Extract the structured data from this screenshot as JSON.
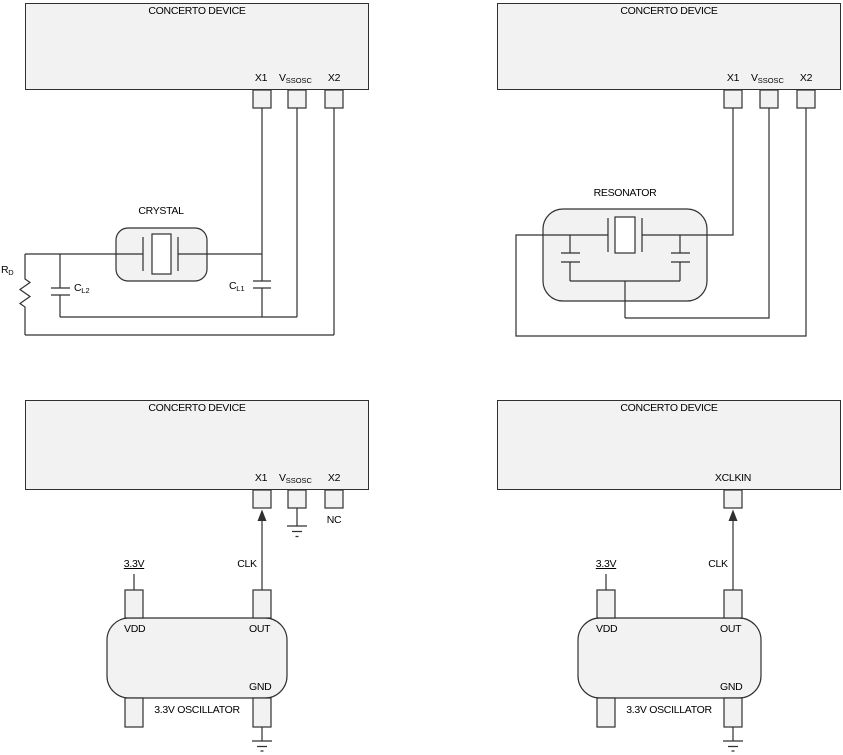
{
  "colors": {
    "stroke": "#303030",
    "box_fill": "#f2f2f2",
    "white_fill": "#ffffff"
  },
  "crystal_circuit": {
    "device_title": "CONCERTO DEVICE",
    "pin_x1": "X1",
    "pin_vssosc_main": "V",
    "pin_vssosc_sub": "SSOSC",
    "pin_x2": "X2",
    "crystal_label": "CRYSTAL",
    "rd_main": "R",
    "rd_sub": "D",
    "cl2_main": "C",
    "cl2_sub": "L2",
    "cl1_main": "C",
    "cl1_sub": "L1"
  },
  "resonator_circuit": {
    "device_title": "CONCERTO DEVICE",
    "pin_x1": "X1",
    "pin_vssosc_main": "V",
    "pin_vssosc_sub": "SSOSC",
    "pin_x2": "X2",
    "resonator_label": "RESONATOR"
  },
  "oscillator_x1_circuit": {
    "device_title": "CONCERTO DEVICE",
    "pin_x1": "X1",
    "pin_vssosc_main": "V",
    "pin_vssosc_sub": "SSOSC",
    "pin_x2": "X2",
    "nc_label": "NC",
    "supply_label": "3.3V",
    "clk_label": "CLK",
    "osc_vdd": "VDD",
    "osc_out": "OUT",
    "osc_gnd": "GND",
    "osc_title": "3.3V OSCILLATOR"
  },
  "oscillator_xclkin_circuit": {
    "device_title": "CONCERTO DEVICE",
    "pin_xclkin": "XCLKIN",
    "supply_label": "3.3V",
    "clk_label": "CLK",
    "osc_vdd": "VDD",
    "osc_out": "OUT",
    "osc_gnd": "GND",
    "osc_title": "3.3V OSCILLATOR"
  }
}
